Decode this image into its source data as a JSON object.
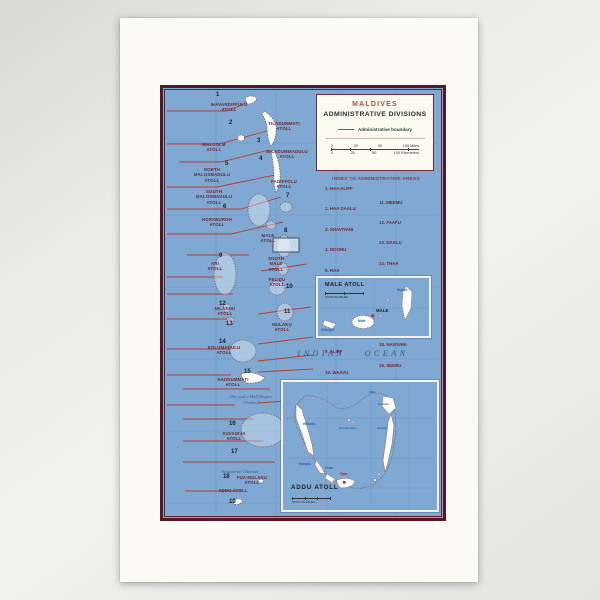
{
  "photo": {
    "description": "Map print photograph"
  },
  "map": {
    "title_box": {
      "country": "MALDIVES",
      "title": "ADMINISTRATIVE DIVISIONS",
      "legend_label": "Administrative boundary",
      "scale_miles": [
        "0",
        "25",
        "50",
        "100 Miles"
      ],
      "scale_km": [
        "0",
        "25",
        "50",
        "100 Kilometers"
      ]
    },
    "index": {
      "heading": "INDEX TO ADMINISTRATIVE AREAS",
      "col1": [
        "1. HAA ALIFF",
        "2. HAA DAALU",
        "3. SHAVIYANI",
        "4. NOONU",
        "5. RAA",
        "6. BAA",
        "7. LAVIYANI",
        "8. KAAFU",
        "9. ALIFF",
        "10. WAAVU"
      ],
      "col2": [
        "11. MEEMU",
        "12. FAAFU",
        "13. DAALU",
        "14. THAA",
        "15. LAAMU",
        "16. GAAF ALIFF",
        "17. GAAF DALU",
        "18. NAVIYANI",
        "19. SEENU"
      ]
    },
    "ocean": "INDIAN OCEAN",
    "channels": {
      "one_and_half": "One and a Half Degree\nChannel",
      "equatorial": "Equatorial Channel"
    },
    "numbers": [
      "1",
      "2",
      "3",
      "4",
      "5",
      "6",
      "7",
      "8",
      "9",
      "10",
      "11",
      "12",
      "13",
      "14",
      "15",
      "16",
      "17",
      "18",
      "19"
    ],
    "atolls": [
      "IHAVANDIFFULU\nATOLL",
      "TILADUMMATI\nATOLL",
      "MALCOLM\nATOLL",
      "MILADUMMADULU\nATOLL",
      "NORTH\nMALOSMADULU\nATOLL",
      "SOUTH\nMALOSMADULU\nATOLL",
      "FADIFFOLU\nATOLL",
      "HORSBURGH\nATOLL",
      "MALE\nATOLL",
      "ARI\nATOLL",
      "SOUTH\nMALE\nATOLL",
      "FELIDU\nATOLL",
      "MULAKU\nATOLL",
      "NILANDU\nATOLL",
      "KOLUMADULU\nATOLL",
      "HADDUMMATI\nATOLL",
      "SUVADIVA\nATOLL",
      "FUA MULAKU\nATOLL",
      "ADDU ATOLL"
    ],
    "male_inset": {
      "title": "MALE ATOLL",
      "scale_label": "STATUTE MILES",
      "wilingili": "Wilingili",
      "male_island": "Male",
      "capital": "MALE",
      "hulule": "Hulule"
    },
    "addu_inset": {
      "title": "ADDU ATOLL",
      "scale_label": "STATUTE MILES",
      "hitaddu": "Hitaddu",
      "maradu": "Maradu",
      "fedu": "Fedu",
      "gan": "Gan",
      "kandu_heru": "Kandu Heru",
      "midu": "Midu",
      "huludu": "Huludu",
      "heradu": "Heradu"
    }
  },
  "colors": {
    "map_blue": "#7fa9d2",
    "border_maroon": "#571824",
    "boundary_red": "#b63c30",
    "atoll_label_maroon": "#6e1f2c",
    "island_label_blue": "#2763ae",
    "title_red": "#c4453e"
  }
}
